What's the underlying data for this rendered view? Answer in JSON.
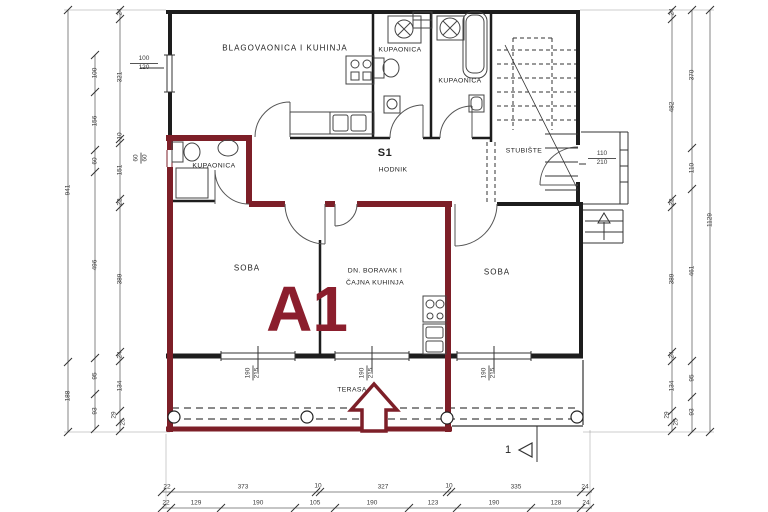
{
  "drawing": {
    "unit_label": "A1",
    "rooms": {
      "dining_kitchen": "BLAGOVAONICA I KUHINJA",
      "bathroom_top1": "KUPAONICA",
      "bathroom_top2": "KUPAONICA",
      "staircase": "STUBIŠTE",
      "hall_id": "S1",
      "hallway": "HODNIK",
      "bathroom_a1": "KUPAONICA",
      "room_left": "SOBA",
      "living_line1": "DN. BORAVAK I",
      "living_line2": "ČAJNA KUHINJA",
      "room_right": "SOBA",
      "terrace": "TERASA"
    },
    "section_marker": "1",
    "window_labels": {
      "left_top": {
        "w": "100",
        "h": "120"
      },
      "left_small": {
        "w": "60",
        "h": "60"
      },
      "stair_door": {
        "w": "110",
        "h": "210"
      },
      "bottom_1": {
        "w": "190",
        "h": "215"
      },
      "bottom_2": {
        "w": "190",
        "h": "215"
      },
      "bottom_3": {
        "w": "190",
        "h": "215"
      }
    },
    "dims": {
      "left_outer": [
        "941",
        "188"
      ],
      "left_mid": [
        "100",
        "156",
        "60",
        "496",
        "95",
        "93"
      ],
      "left_inner": [
        "24",
        "321",
        "10",
        "151",
        "22",
        "389",
        "24",
        "134",
        "29",
        "25"
      ],
      "right_inner": [
        "24",
        "482",
        "22",
        "389",
        "24",
        "134",
        "29",
        "25"
      ],
      "right_mid": [
        "370",
        "110",
        "461",
        "95",
        "93"
      ],
      "right_outer": [
        "1129"
      ],
      "bottom_row1": [
        "22",
        "373",
        "10",
        "327",
        "10",
        "335",
        "24"
      ],
      "bottom_row2": [
        "22",
        "129",
        "190",
        "105",
        "190",
        "123",
        "190",
        "128",
        "24"
      ]
    },
    "colors": {
      "unit_outline": "#7D1F28",
      "unit_text": "#8B1E2D",
      "walls": "#1d1d1d"
    }
  }
}
